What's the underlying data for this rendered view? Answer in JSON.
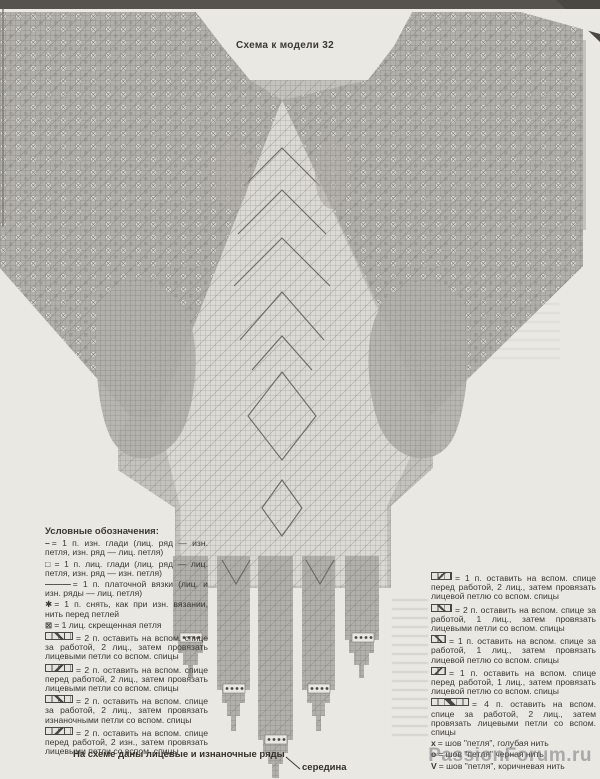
{
  "page": {
    "title": "Схема к модели 32",
    "footer_note": "На схеме даны лицевые и изнаночные ряды",
    "center_label": "середина",
    "watermark": "PassionForum.ru"
  },
  "chart": {
    "type": "knitting-pattern-grid",
    "shape": "shawl with stepped top edge, narrowing triangular body and five hanging tassels of different lengths",
    "center_marker": "середина points to longest central tassel",
    "tassel_tip_depths_px": [
      678,
      731,
      778,
      731,
      678
    ]
  },
  "legend_left": {
    "header": "Условные обозначения:",
    "items": [
      {
        "symbol": "purl-dash",
        "glyph": "–",
        "text": "= 1 п. изн. глади (лиц. ряд — изн. петля, изн. ряд — лиц. петля)"
      },
      {
        "symbol": "knit-square",
        "glyph": "□",
        "text": "= 1 п. лиц. глади (лиц. ряд — лиц. петля, изн. ряд — изн. петля)"
      },
      {
        "symbol": "garter-line",
        "glyph": "———",
        "text": "= 1 п. платочной вязки (лиц. и изн. ряды — лиц. петля)"
      },
      {
        "symbol": "slip-stitch-star",
        "glyph": "✱",
        "text": "= 1 п. снять, как при изн. вязании, нить перед петлей"
      },
      {
        "symbol": "crossed-stitch",
        "glyph": "⊠",
        "text": "= 1 лиц. скрещенная петля"
      },
      {
        "symbol": "cable-2-2-back",
        "glyph": "",
        "text": "= 2 п. оставить на вспом. спице за работой, 2 лиц., затем провязать лицевыми петли со вспом. спицы"
      },
      {
        "symbol": "cable-2-2-front",
        "glyph": "",
        "text": "= 2 п. оставить на вспом. спице перед работой, 2 лиц., затем провязать лицевыми петли со вспом. спицы"
      },
      {
        "symbol": "cable-2-2-back-purl",
        "glyph": "",
        "text": "= 2 п. оставить на вспом. спице за работой, 2 лиц., затем провязать изнаночными петли со вспом. спицы"
      },
      {
        "symbol": "cable-2-2-front-purl",
        "glyph": "",
        "text": "= 2 п. оставить на вспом. спице перед работой, 2 изн., затем провязать лицевыми петли со вспом. спицы"
      }
    ]
  },
  "legend_right": {
    "items": [
      {
        "symbol": "cable-1-2-front",
        "glyph": "",
        "text": "= 1 п. оставить на вспом. спице перед работой, 2 лиц., затем провязать лицевой петлю со вспом. спицы"
      },
      {
        "symbol": "cable-2-1-back",
        "glyph": "",
        "text": "= 2 п. оставить на вспом. спице за работой, 1 лиц., затем провязать лицевыми петли со вспом. спицы"
      },
      {
        "symbol": "cable-1-1-back",
        "glyph": "",
        "text": "= 1 п. оставить на вспом. спице за работой, 1 лиц., затем провязать лицевой петлю со вспом. спицы"
      },
      {
        "symbol": "cable-1-1-front",
        "glyph": "",
        "text": "= 1 п. оставить на вспом. спице перед работой, 1 лиц., затем провязать лицевой петлю со вспом. спицы"
      },
      {
        "symbol": "cable-4-2-back",
        "glyph": "",
        "text": "= 4 п. оставить на вспом. спице за работой, 2 лиц., затем провязать лицевыми петли со вспом. спицы"
      },
      {
        "symbol": "seam-x",
        "glyph": "х",
        "text": "= шов \"петля\", голубая нить"
      },
      {
        "symbol": "seam-o",
        "glyph": "о",
        "text": "= шов \"петля\" черная нить"
      },
      {
        "symbol": "seam-v",
        "glyph": "V",
        "text": "= шов \"петля\", коричневая нить"
      }
    ]
  },
  "colors": {
    "paper": "#eae8e3",
    "grid_dense": "#b2b0ab",
    "grid_mid": "#c3c1bc",
    "grid_light": "#dbd9d4",
    "grid_line": "#8e8c88",
    "ink": "#34322e",
    "scan_bar": "#56534e"
  }
}
